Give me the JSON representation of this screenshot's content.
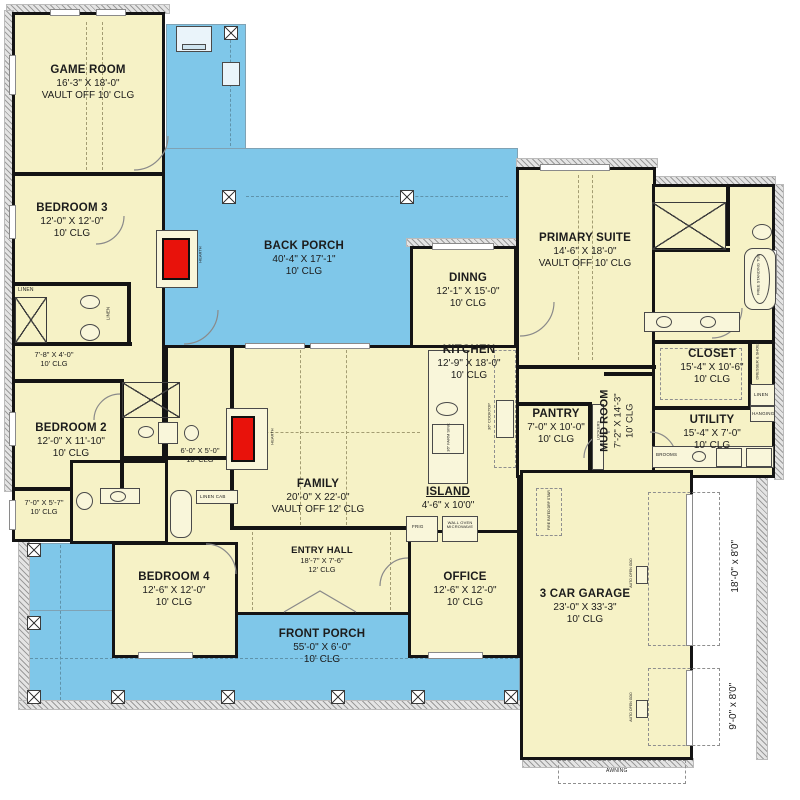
{
  "colors": {
    "room_fill": "#f6f2c6",
    "porch_fill": "#7fc7e9",
    "wall": "#141414",
    "fireplace_red": "#e8120b",
    "hatch_gray": "#9b9b9b"
  },
  "rooms": [
    {
      "id": "game-room",
      "name": "GAME ROOM",
      "dims": "16'-3\" X 18'-0\"",
      "clg": "VAULT OFF 10' CLG"
    },
    {
      "id": "bedroom-3",
      "name": "BEDROOM 3",
      "dims": "12'-0\" X 12'-0\"",
      "clg": "10' CLG"
    },
    {
      "id": "back-porch",
      "name": "BACK PORCH",
      "dims": "40'-4\" X 17'-1\"",
      "clg": "10' CLG"
    },
    {
      "id": "dining",
      "name": "DINNG",
      "dims": "12'-1\" X 15'-0\"",
      "clg": "10' CLG"
    },
    {
      "id": "primary-suite",
      "name": "PRIMARY SUITE",
      "dims": "14'-6\" X 18'-0\"",
      "clg": "VAULT OFF 10' CLG"
    },
    {
      "id": "kitchen",
      "name": "KITCHEN",
      "dims": "12'-9\" X 18'-0\"",
      "clg": "10' CLG"
    },
    {
      "id": "closet",
      "name": "CLOSET",
      "dims": "15'-4\" X 10'-6\"",
      "clg": "10' CLG"
    },
    {
      "id": "pantry",
      "name": "PANTRY",
      "dims": "7'-0\" X 10'-0\"",
      "clg": "10' CLG"
    },
    {
      "id": "mud-room",
      "name": "MUD ROOM",
      "dims": "7'-2\" X 14'-3\"",
      "clg": "10' CLG"
    },
    {
      "id": "utility",
      "name": "UTILITY",
      "dims": "15'-4\" X 7'-0\"",
      "clg": "10' CLG"
    },
    {
      "id": "bedroom-2",
      "name": "BEDROOM 2",
      "dims": "12'-0\" X 11'-10\"",
      "clg": "10' CLG"
    },
    {
      "id": "family",
      "name": "FAMILY",
      "dims": "20'-0\" X 22'-0\"",
      "clg": "VAULT OFF 12' CLG"
    },
    {
      "id": "island",
      "name": "ISLAND",
      "dims": "4'-6\" x 10'0\""
    },
    {
      "id": "entry-hall",
      "name": "ENTRY HALL",
      "dims": "18'-7\" X 7'-6\"",
      "clg": "12' CLG"
    },
    {
      "id": "bedroom-4",
      "name": "BEDROOM 4",
      "dims": "12'-6\" X 12'-0\"",
      "clg": "10' CLG"
    },
    {
      "id": "office",
      "name": "OFFICE",
      "dims": "12'-6\" X 12'-0\"",
      "clg": "10' CLG"
    },
    {
      "id": "front-porch",
      "name": "FRONT PORCH",
      "dims": "55'-0\" X 6'-0\"",
      "clg": "10' CLG"
    },
    {
      "id": "garage",
      "name": "3 CAR GARAGE",
      "dims": "23'-0\" X 33'-3\"",
      "clg": "10' CLG"
    },
    {
      "id": "hall",
      "dims": "7'-8\" X 4'-0\"",
      "clg": "10' CLG"
    },
    {
      "id": "closet-2",
      "dims": "6'-0\" X 5'-0\"",
      "clg": "10' CLG"
    },
    {
      "id": "flex",
      "dims": "7'-0\" X 5'-7\"",
      "clg": "10' CLG"
    }
  ],
  "labels": {
    "hearth": "HEARTH",
    "linen": "LINEN",
    "linen_cab": "LINEN CAB",
    "lockers": "LOCKERS",
    "brooms": "BROOMS",
    "hanging": "HANGING",
    "dresser_shoes": "DRESSER & SHOES",
    "free_standing_tub": "FREE STANDING TUB",
    "frig": "FRIG",
    "wall_oven": "WALL OVEN MICROWAVE",
    "cooktop": "36\" COOKTOP",
    "farm_sink": "36\" FARM SINK",
    "fire_stair": "FIRE RATED DRP STAIR",
    "awning": "AWNING",
    "auto_open": "AUTO OPEN GDO",
    "door_18": "18'-0\" x 8'0\"",
    "door_9": "9'-0\" x 8'0\""
  }
}
